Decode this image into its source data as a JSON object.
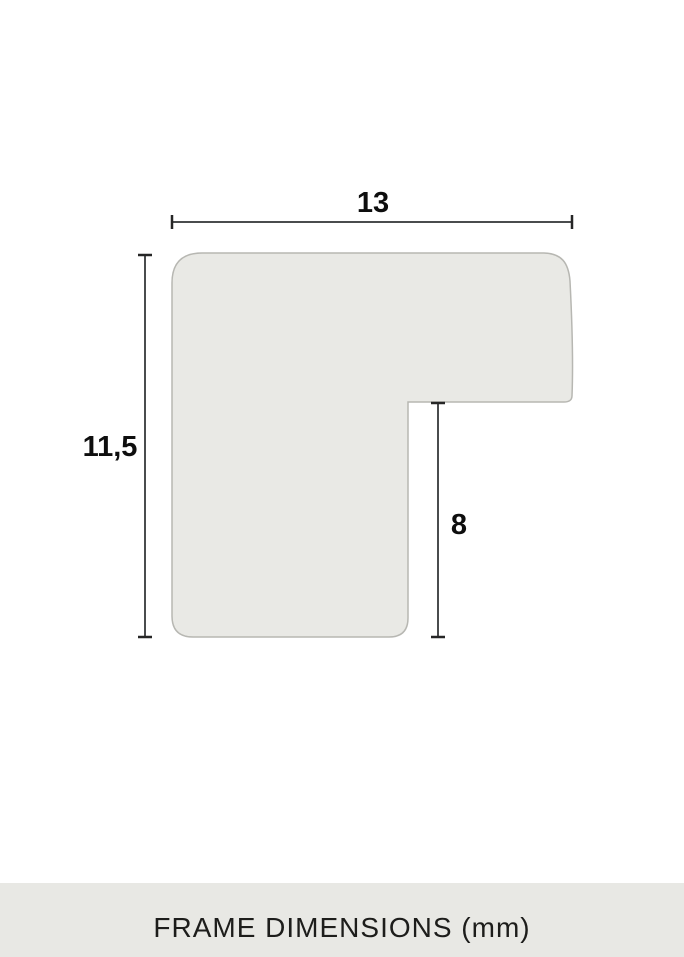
{
  "diagram": {
    "title": "Frame profile cross-section drawing",
    "width_label": "13",
    "height_label": "11,5",
    "rabbet_label": "8",
    "unit": "mm"
  },
  "footer": {
    "caption": "FRAME DIMENSIONS (mm)"
  },
  "colors": {
    "background": "#ffffff",
    "shape_fill": "#e9e9e5",
    "shape_stroke": "#b7b7b2",
    "dimension_line": "#4a4c4d",
    "dimension_tick": "#262626",
    "label_text": "#0e0e0e",
    "footer_background": "#e8e8e4",
    "footer_text": "#1d1d1b"
  }
}
